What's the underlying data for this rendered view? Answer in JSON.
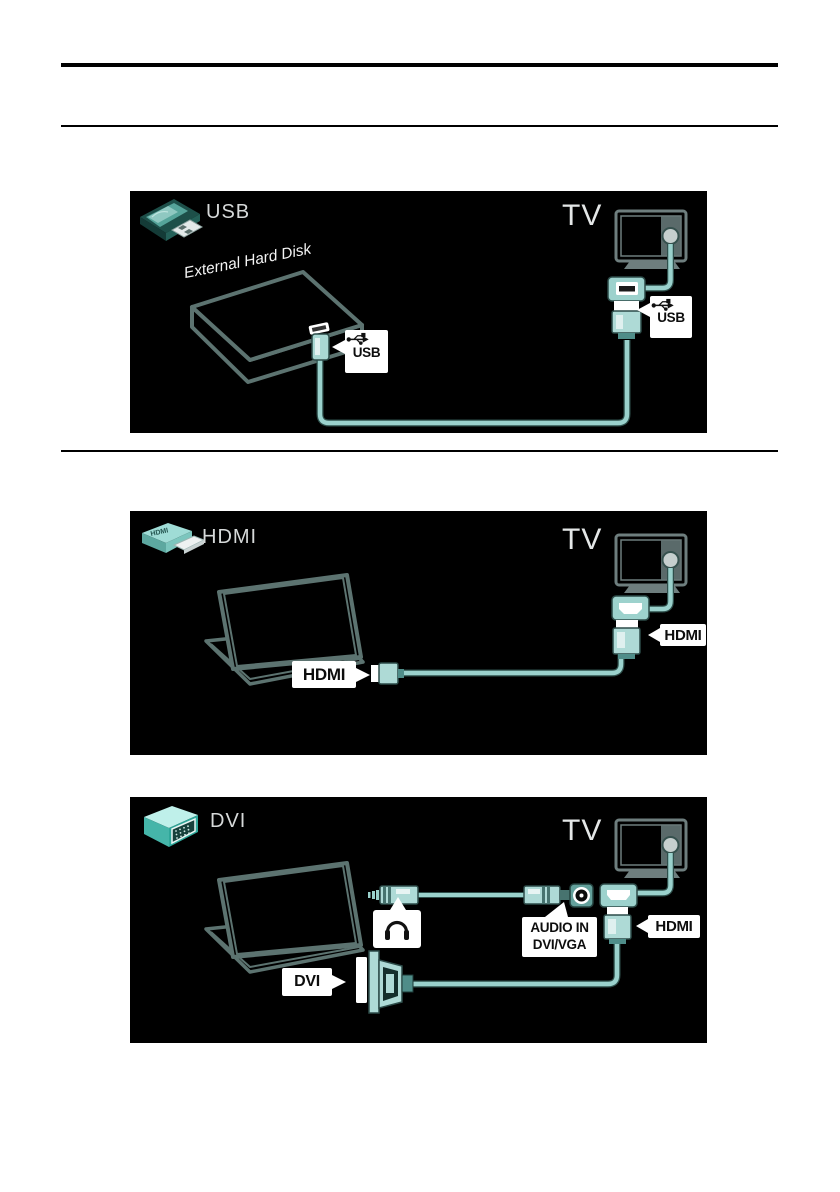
{
  "panels": {
    "usb": {
      "title": "USB",
      "device_label": "External Hard Disk",
      "tv_label": "TV",
      "source_port_label": "USB",
      "tv_port_label": "USB"
    },
    "hdmi": {
      "title": "HDMI",
      "icon_text": "HDMI",
      "tv_label": "TV",
      "source_port_label": "HDMI",
      "tv_port_label": "HDMI"
    },
    "dvi": {
      "title": "DVI",
      "tv_label": "TV",
      "source_port_label": "DVI",
      "audio_in_line1": "AUDIO IN",
      "audio_in_line2": "DVI/VGA",
      "tv_port_label": "HDMI"
    }
  },
  "colors": {
    "panel_bg": "#000000",
    "cable_light": "#9ad1cc",
    "cable_dark": "#2e4f4b",
    "connector_teal": "#aedad6",
    "socket_teal": "#9dd2cd",
    "device_outline": "#5c7370",
    "tv_outline": "#6e7e7e",
    "label_bg": "#ffffff",
    "label_text": "#0d0d0d"
  }
}
